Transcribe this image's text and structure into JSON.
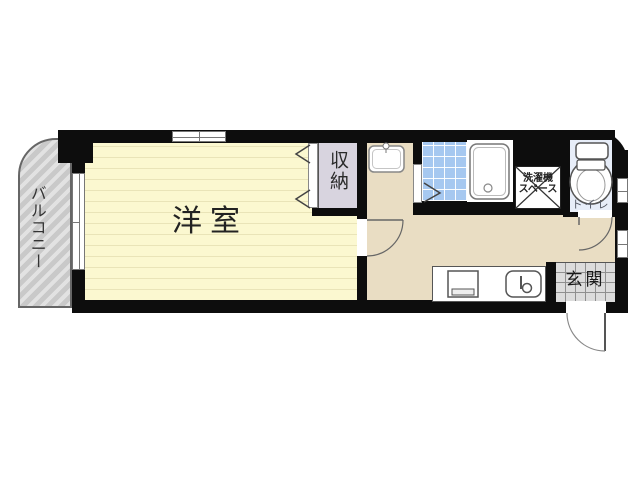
{
  "floorplan": {
    "balcony": {
      "label": "バルコニー"
    },
    "western_room": {
      "label": "洋室"
    },
    "closet": {
      "label": "収納"
    },
    "washer_space": {
      "line1": "洗濯機",
      "line2": "スペース"
    },
    "toilet": {
      "label": "トイレ"
    },
    "entrance": {
      "label": "玄関"
    },
    "colors": {
      "wall": "#0d0d0d",
      "room_fill": "#fbf8d0",
      "room_stripe": "#e9e4b8",
      "hall_fill": "#e9ddc3",
      "closet_fill": "#d8d4df",
      "bath_tile": "#a6c8f0",
      "toilet_room_fill": "#e7edf8",
      "entrance_tile": "#dcdcdc",
      "balcony_fill": "#c9c9c9"
    }
  }
}
